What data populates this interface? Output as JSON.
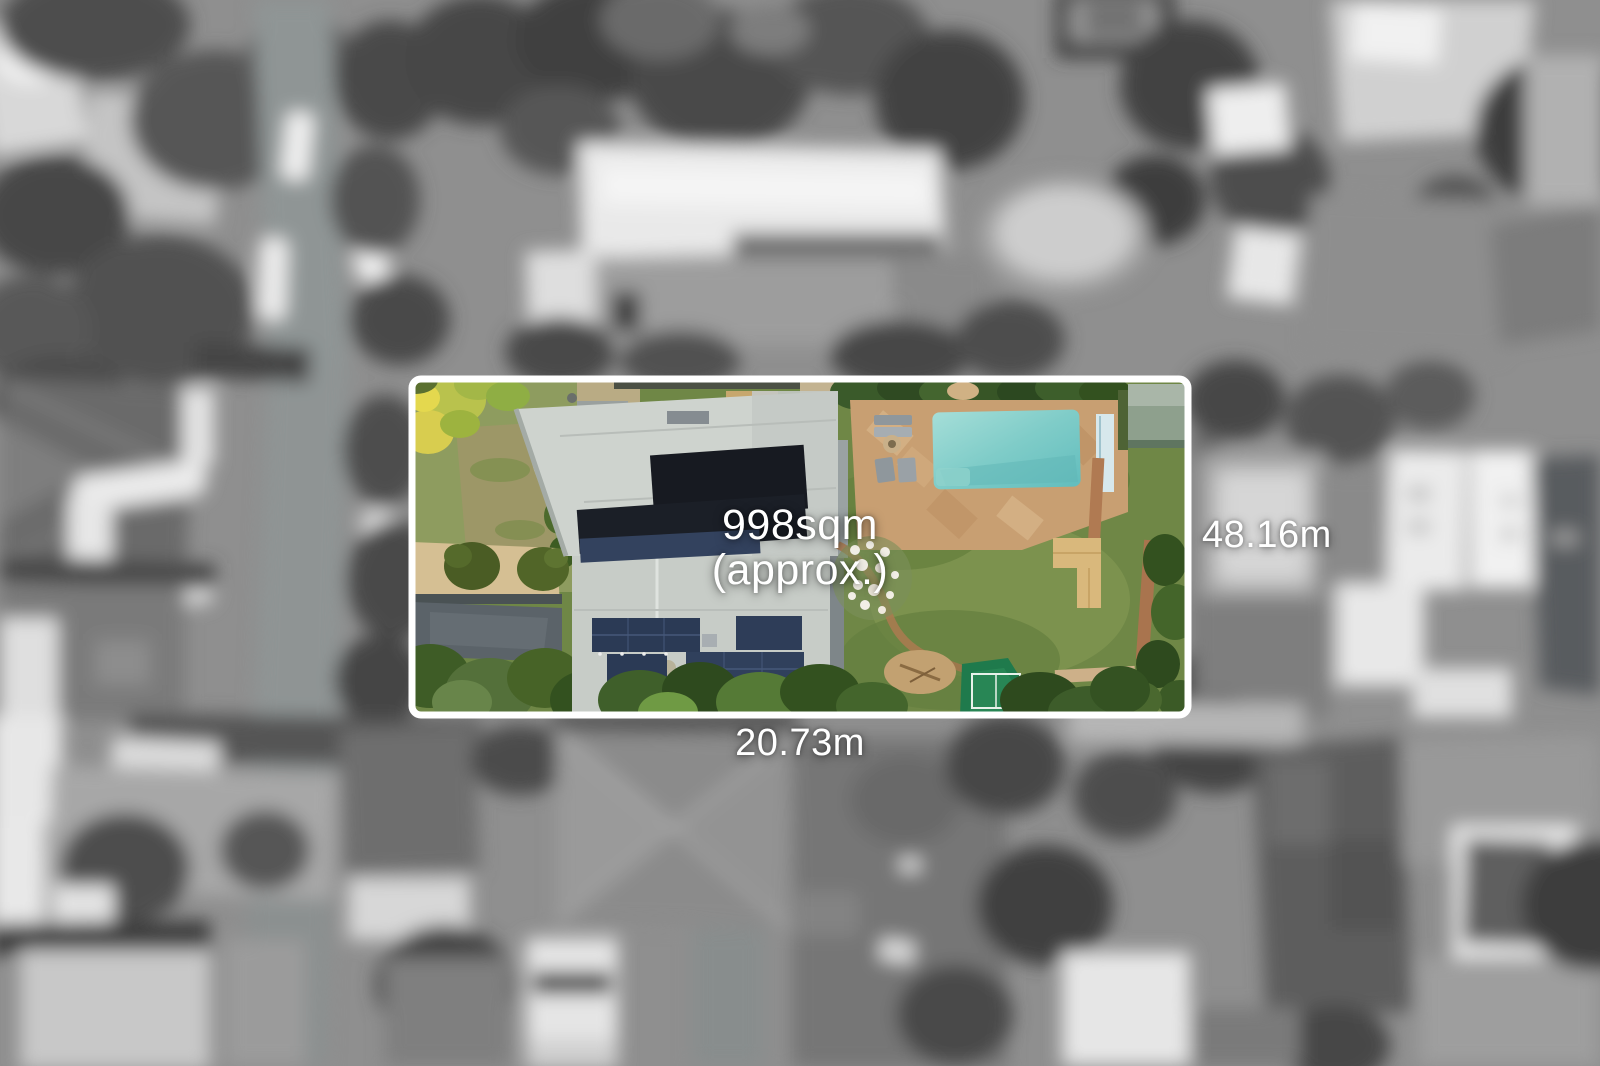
{
  "labels": {
    "area": "998sqm",
    "area_qualifier": "(approx.)",
    "side_length": "48.16m",
    "frontage": "20.73m"
  },
  "colors": {
    "boundary-white": "#ffffff",
    "label-text": "#ffffff",
    "pool-water": "#7fccc8",
    "pool-paving": "#c89f72",
    "lawn-green": "#6f8746",
    "tree-dark-green": "#33511f",
    "tree-yellow-green": "#c6c94f",
    "roof-light-gray": "#ced3ce",
    "solar-panel-dark": "#171a21",
    "solar-panel-blue": "#2b3a55",
    "driveway-gray": "#5b6369",
    "sand-tan": "#d5bf93",
    "deck-timber": "#d9b87c",
    "sports-court-green": "#1f7a4c",
    "background-gray": "#8f8f8f"
  }
}
